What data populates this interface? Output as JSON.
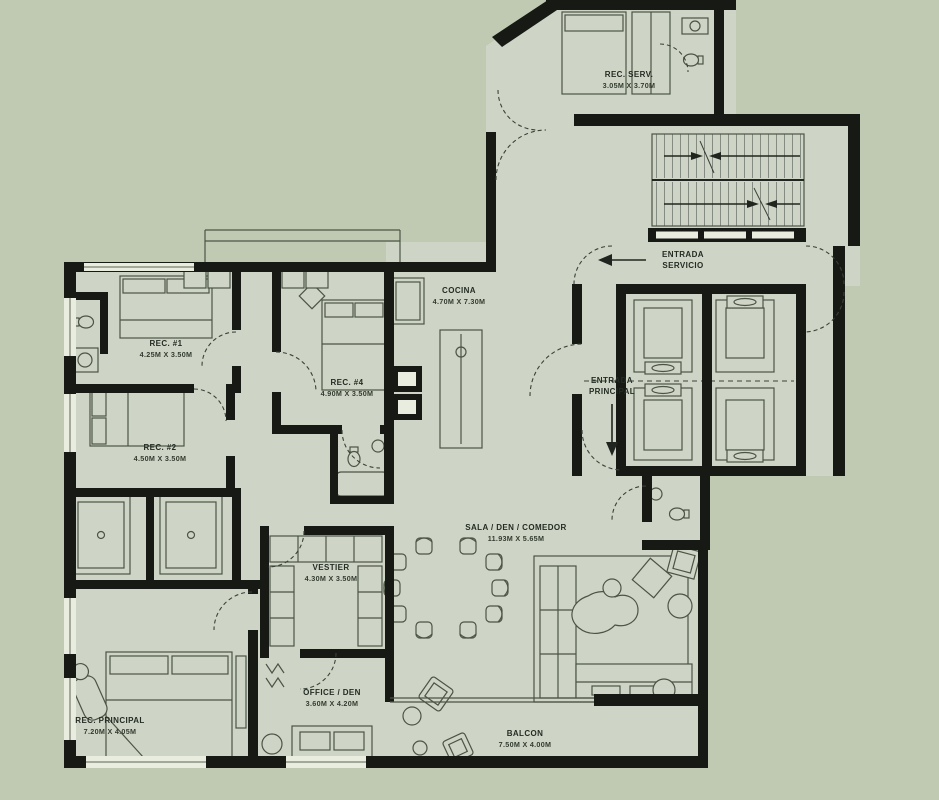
{
  "plan": {
    "colors": {
      "background": "#c0cab3",
      "floor": "#cfd5c6",
      "wall": "#161914",
      "furniture_line": "#4c5446",
      "label_text": "#242c24"
    },
    "rooms": [
      {
        "id": "rec-serv",
        "name": "REC. SERV.",
        "dims": "3.05M X 3.70M"
      },
      {
        "id": "cocina",
        "name": "COCINA",
        "dims": "4.70M X 7.30M"
      },
      {
        "id": "rec-1",
        "name": "REC. #1",
        "dims": "4.25M X 3.50M"
      },
      {
        "id": "rec-4",
        "name": "REC. #4",
        "dims": "4.90M X 3.50M"
      },
      {
        "id": "rec-2",
        "name": "REC. #2",
        "dims": "4.50M X 3.50M"
      },
      {
        "id": "sala",
        "name": "SALA / DEN / COMEDOR",
        "dims": "11.93M X 5.65M"
      },
      {
        "id": "vestier",
        "name": "VESTIER",
        "dims": "4.30M X 3.50M"
      },
      {
        "id": "office",
        "name": "OFFICE / DEN",
        "dims": "3.60M X 4.20M"
      },
      {
        "id": "rec-principal",
        "name": "REC. PRINCIPAL",
        "dims": "7.20M X 4.05M"
      },
      {
        "id": "balcon",
        "name": "BALCON",
        "dims": "7.50M X 4.00M"
      }
    ],
    "entrances": [
      {
        "id": "servicio",
        "line1": "ENTRADA",
        "line2": "SERVICIO",
        "arrow": "left"
      },
      {
        "id": "principal",
        "line1": "ENTRADA",
        "line2": "PRINCIPAL",
        "arrow": "down"
      }
    ]
  }
}
